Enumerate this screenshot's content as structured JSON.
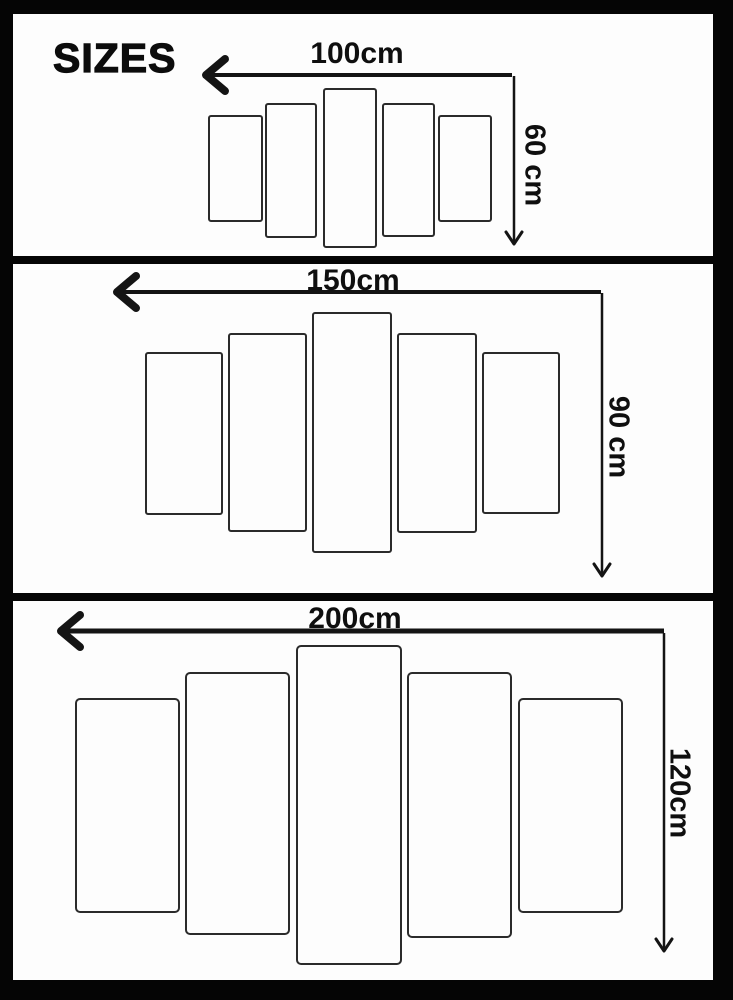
{
  "title": "SIZES",
  "sections": [
    {
      "name": "size-100x60",
      "width_label": "100cm",
      "height_label": "60 cm",
      "width_cm": 100,
      "height_cm": 60,
      "panel_count": 5
    },
    {
      "name": "size-150x90",
      "width_label": "150cm",
      "height_label": "90 cm",
      "width_cm": 150,
      "height_cm": 90,
      "panel_count": 5
    },
    {
      "name": "size-200x120",
      "width_label": "200cm",
      "height_label": "120cm",
      "width_cm": 200,
      "height_cm": 120,
      "panel_count": 5
    }
  ],
  "colors": {
    "frame": "#050505",
    "background": "#fdfdfd",
    "line": "#141414"
  }
}
